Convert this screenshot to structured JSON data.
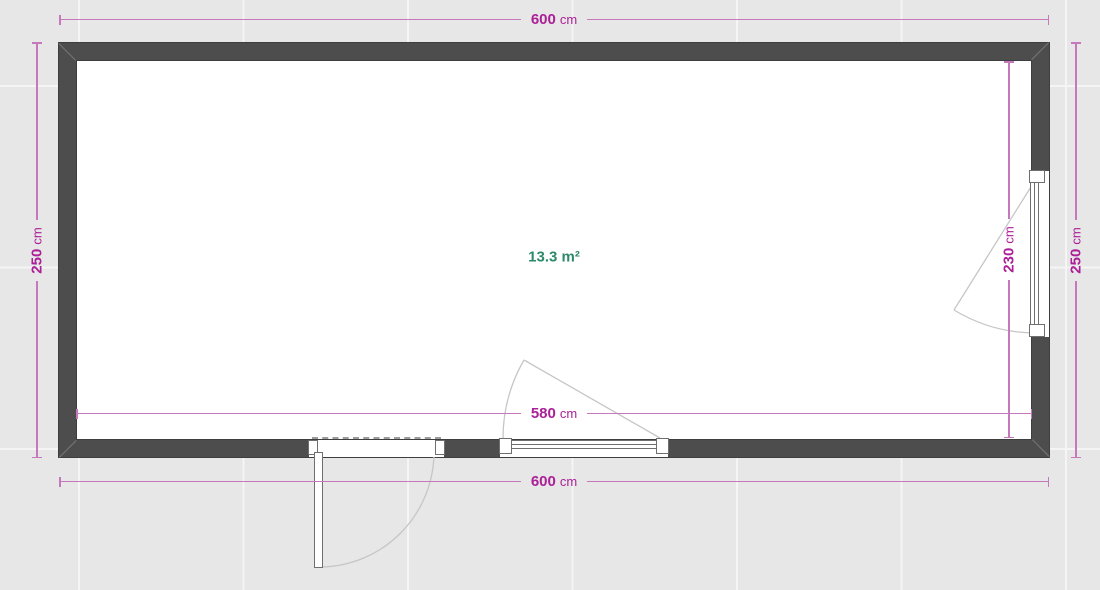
{
  "plan": {
    "area": {
      "label": "13.3 m²"
    },
    "dimensions": {
      "top": {
        "value": "600",
        "unit": "cm"
      },
      "bottom": {
        "value": "600",
        "unit": "cm"
      },
      "inner_width": {
        "value": "580",
        "unit": "cm"
      },
      "left": {
        "value": "250",
        "unit": "cm"
      },
      "right_outer": {
        "value": "250",
        "unit": "cm"
      },
      "right_inner": {
        "value": "230",
        "unit": "cm"
      }
    },
    "colors": {
      "wall": "#4d4d4d",
      "dimension_text": "#ab1f97",
      "dimension_line": "#c678bd",
      "area_text": "#2c8a68",
      "canvas_background": "#e8e7e7"
    }
  }
}
